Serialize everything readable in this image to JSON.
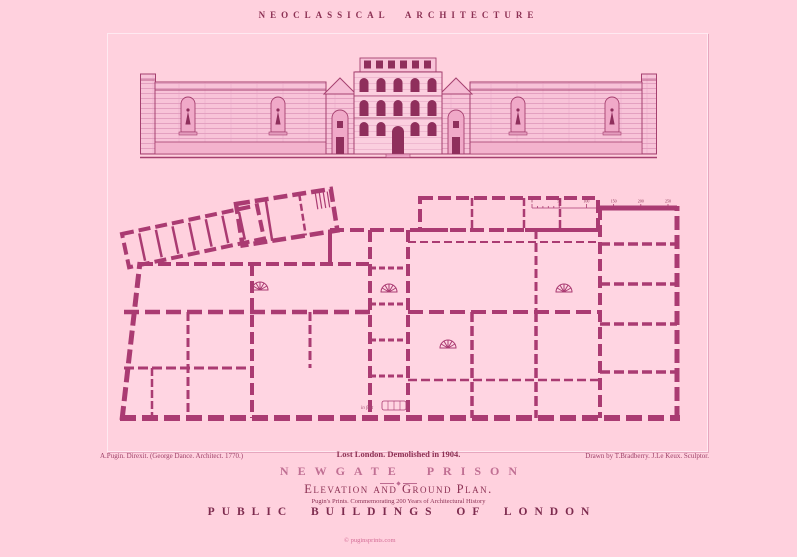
{
  "colors": {
    "background": "#ffd1de",
    "drawing_ink": "#aa3b72",
    "text_dark": "#8c3154",
    "text_light": "#c06f93",
    "window_ink": "#8f2f5c"
  },
  "header": {
    "title": "NEOCLASSICAL ARCHITECTURE"
  },
  "captions": {
    "left": "A.Pugin. Direxit. (George Dance. Architect. 1770.)",
    "center": "Lost London. Demolished in 1904.",
    "right": "Drawn by T.Bradberry. J.Le Keux. Sculptor."
  },
  "titles": {
    "main": "NEWGATE PRISON",
    "subtitle": "Elevation and Ground Plan.",
    "series_note": "Pugin's Prints. Commemorating 200 Years of Architectural History",
    "series_title": "PUBLIC BUILDINGS OF LONDON"
  },
  "plan": {
    "scale_labels": [
      "0",
      "50",
      "100",
      "150",
      "200",
      "250"
    ],
    "scale_note": "in feet"
  },
  "footer": {
    "watermark": "© puginsprints.com"
  }
}
